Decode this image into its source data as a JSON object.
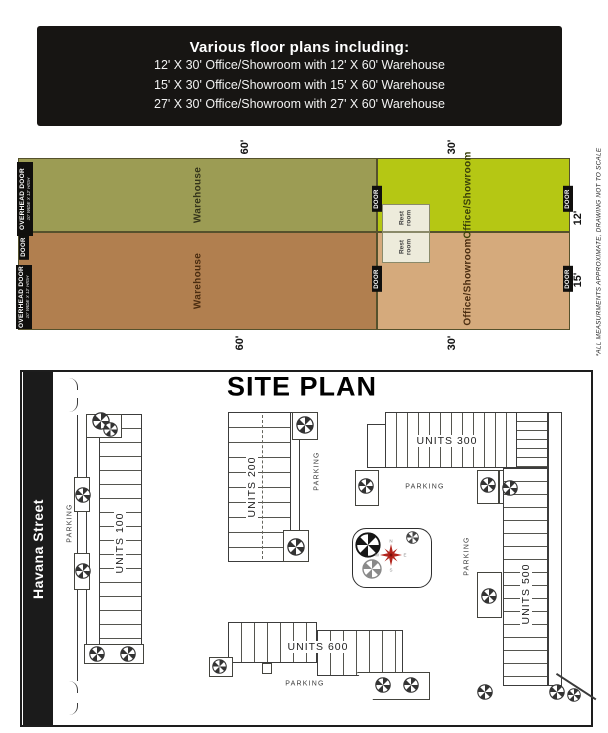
{
  "header": {
    "title": "Various floor plans including:",
    "lines": [
      "12' X 30' Office/Showroom with 12' X 60' Warehouse",
      "15' X 30' Office/Showroom with 15' X 60' Warehouse",
      "27' X 30' Office/Showroom with 27' X 60' Warehouse"
    ]
  },
  "floor_plan": {
    "warehouse_label": "Warehouse",
    "office_label": "Office/Showroom",
    "restroom_line1": "Rest",
    "restroom_line2": "room",
    "door_label": "DOOR",
    "overhead_door_label": "OVERHEAD DOOR",
    "overhead_door_sub": "10' WIDE X 12' HIGH",
    "dim_warehouse": "60'",
    "dim_office": "30'",
    "dim_unit12": "12'",
    "dim_unit15": "15'",
    "disclaimer": "*ALL MEASURMENTS APPROXIMATE, DRAWING NOT TO SCALE",
    "colors": {
      "warehouse_top": "#9c9c54",
      "office_top": "#b5c714",
      "warehouse_bottom": "#b17f4f",
      "office_bottom": "#d5aa7c",
      "restroom": "#edebdb"
    }
  },
  "site_plan": {
    "title": "SITE PLAN",
    "street_name": "Havana Street",
    "parking_label": "PARKING",
    "units_100": "UNITS 100",
    "units_200": "UNITS 200",
    "units_300": "UNITS 300",
    "units_500": "UNITS 500",
    "units_600": "UNITS 600",
    "compass": {
      "n": "N",
      "e": "E",
      "s": "S",
      "w": "W"
    }
  }
}
